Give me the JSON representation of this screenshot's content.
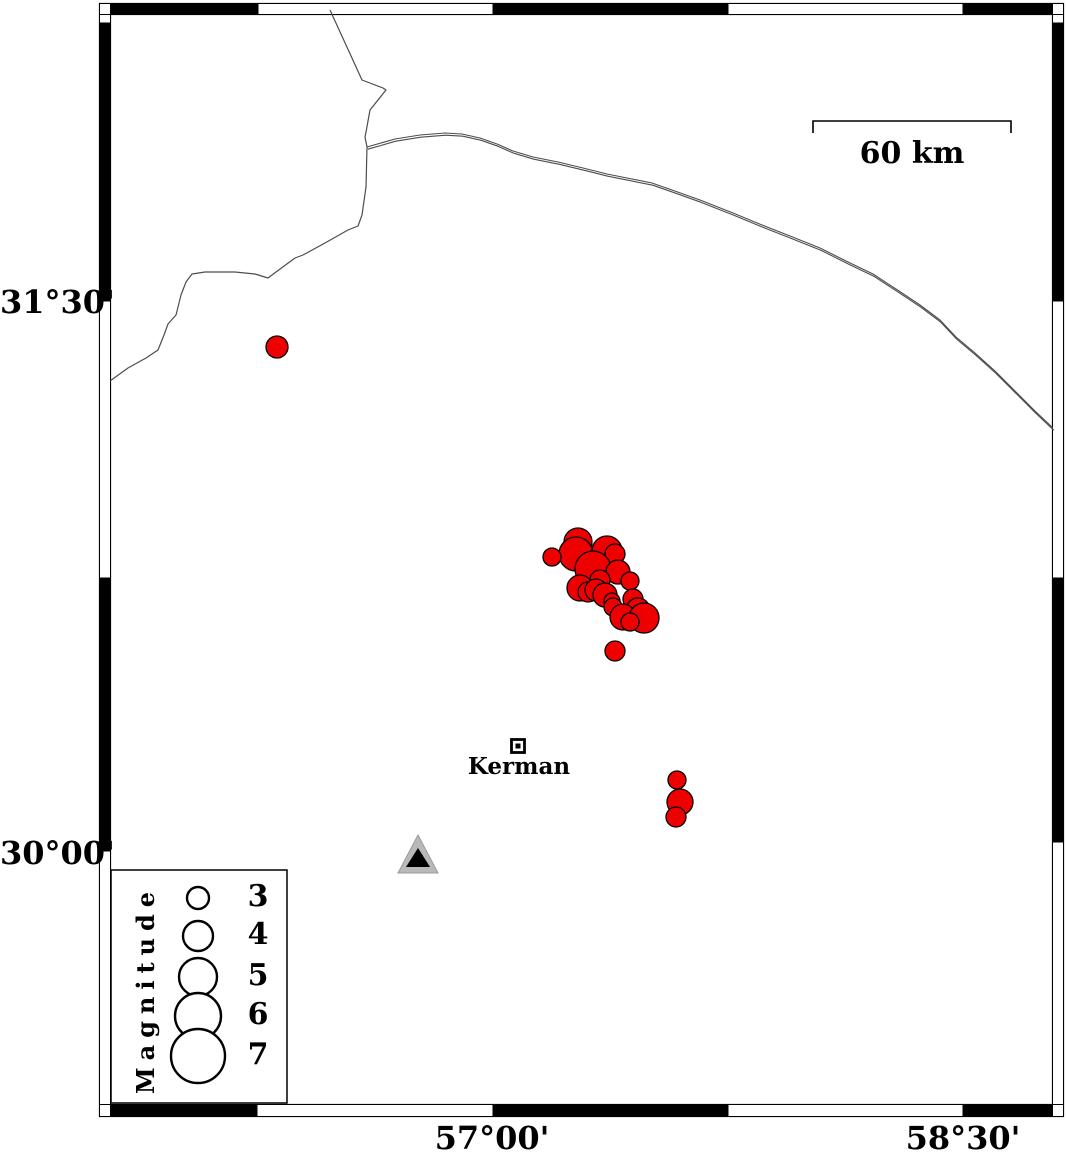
{
  "frame": {
    "lat_labels": [
      {
        "text": "31°30'",
        "tick_y": 301
      },
      {
        "text": "30°00'",
        "tick_y": 852
      }
    ],
    "lon_labels": [
      {
        "text": "57°00'",
        "tick_x": 493
      },
      {
        "text": "58°30'",
        "tick_x": 963
      }
    ]
  },
  "scale_bar": {
    "label": "60 km",
    "x1": 813,
    "x2": 1011,
    "y": 121,
    "tick_drop": 12
  },
  "city": {
    "label": "Kerman",
    "x": 518,
    "y": 746
  },
  "station": {
    "name": "station-triangle",
    "x": 418,
    "y": 855
  },
  "legend": {
    "title": "Magnitude",
    "circle_x": 198,
    "label_x_left": 238,
    "entries": [
      {
        "mag": "3",
        "r": 11,
        "cy": 898
      },
      {
        "mag": "4",
        "r": 15,
        "cy": 936
      },
      {
        "mag": "5",
        "r": 19,
        "cy": 977
      },
      {
        "mag": "6",
        "r": 23,
        "cy": 1016
      },
      {
        "mag": "7",
        "r": 27,
        "cy": 1056
      }
    ]
  },
  "colors": {
    "epicenter_fill": "#ee0000",
    "line": "#4d4d4d",
    "station_gray": "#b9b9b9",
    "frame_black": "#000000"
  },
  "epicenters": {
    "points": [
      [
        578,
        542,
        14
      ],
      [
        576,
        554,
        17
      ],
      [
        552,
        557,
        9
      ],
      [
        607,
        551,
        15
      ],
      [
        615,
        554,
        10
      ],
      [
        593,
        569,
        18
      ],
      [
        618,
        572,
        12
      ],
      [
        600,
        580,
        10
      ],
      [
        630,
        581,
        9
      ],
      [
        580,
        588,
        13
      ],
      [
        588,
        592,
        10
      ],
      [
        596,
        590,
        11
      ],
      [
        605,
        595,
        12
      ],
      [
        633,
        599,
        10
      ],
      [
        612,
        601,
        8
      ],
      [
        613,
        607,
        9
      ],
      [
        638,
        610,
        12
      ],
      [
        623,
        617,
        13
      ],
      [
        644,
        618,
        15
      ],
      [
        630,
        622,
        9
      ],
      [
        615,
        651,
        10
      ],
      [
        277,
        347,
        11
      ],
      [
        677,
        780,
        9
      ],
      [
        680,
        802,
        13
      ],
      [
        676,
        817,
        10
      ]
    ]
  },
  "lines": {
    "boundary": [
      [
        330,
        10
      ],
      [
        362,
        80
      ],
      [
        383,
        88
      ],
      [
        386,
        90
      ],
      [
        370,
        110
      ],
      [
        366,
        132
      ],
      [
        365,
        137
      ],
      [
        367,
        147
      ],
      [
        366,
        187
      ],
      [
        362,
        215
      ],
      [
        358,
        226
      ],
      [
        348,
        230
      ],
      [
        325,
        243
      ],
      [
        303,
        255
      ],
      [
        295,
        258
      ],
      [
        276,
        272
      ],
      [
        268,
        278
      ],
      [
        255,
        274
      ],
      [
        235,
        272
      ],
      [
        225,
        272
      ],
      [
        205,
        272
      ],
      [
        192,
        274
      ],
      [
        186,
        282
      ],
      [
        181,
        295
      ],
      [
        176,
        315
      ],
      [
        168,
        324
      ],
      [
        164,
        335
      ],
      [
        158,
        350
      ],
      [
        146,
        358
      ],
      [
        128,
        368
      ],
      [
        110,
        381
      ]
    ],
    "road": [
      [
        367,
        147
      ],
      [
        395,
        139
      ],
      [
        420,
        135
      ],
      [
        445,
        133
      ],
      [
        462,
        134
      ],
      [
        480,
        138
      ],
      [
        497,
        144
      ],
      [
        513,
        151
      ],
      [
        533,
        157
      ],
      [
        558,
        162
      ],
      [
        583,
        168
      ],
      [
        607,
        174
      ],
      [
        627,
        178
      ],
      [
        652,
        183
      ],
      [
        672,
        190
      ],
      [
        700,
        200
      ],
      [
        733,
        213
      ],
      [
        762,
        225
      ],
      [
        790,
        236
      ],
      [
        820,
        248
      ],
      [
        848,
        262
      ],
      [
        873,
        274
      ],
      [
        899,
        291
      ],
      [
        920,
        305
      ],
      [
        940,
        320
      ],
      [
        956,
        337
      ],
      [
        975,
        353
      ],
      [
        995,
        371
      ],
      [
        1015,
        391
      ],
      [
        1035,
        411
      ],
      [
        1053,
        428
      ]
    ]
  }
}
